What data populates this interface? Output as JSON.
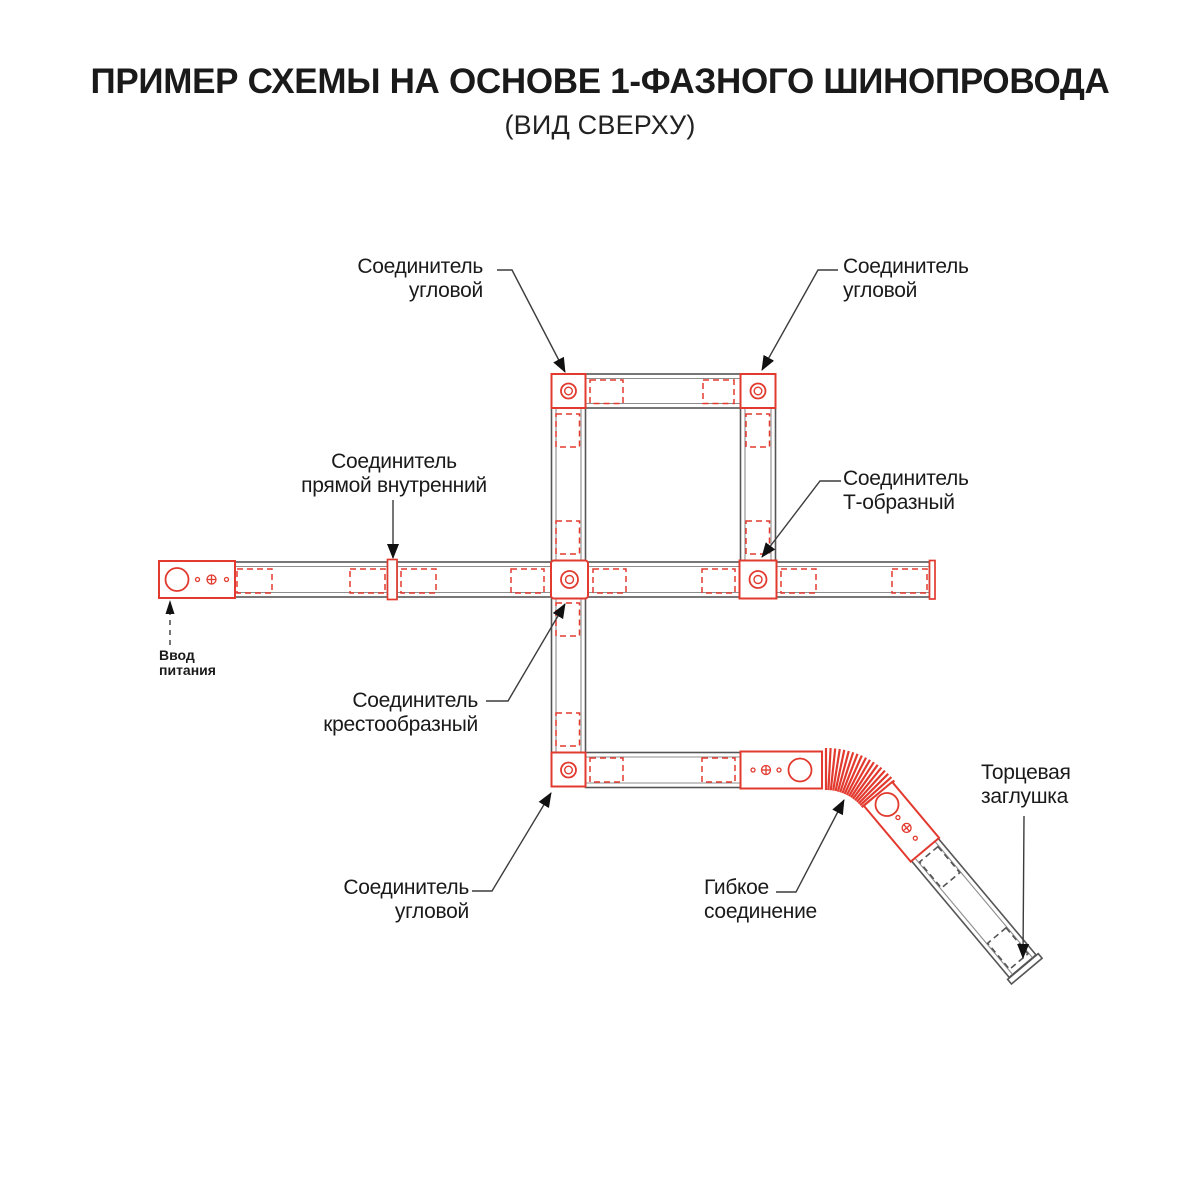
{
  "title": "ПРИМЕР СХЕМЫ НА ОСНОВЕ 1-ФАЗНОГО ШИНОПРОВОДА",
  "subtitle": "(ВИД СВЕРХУ)",
  "labels": {
    "corner_top_left": "Соединитель\nугловой",
    "corner_top_right": "Соединитель\nугловой",
    "straight_internal": "Соединитель\nпрямой внутренний",
    "t_shaped": "Соединитель\nТ-образный",
    "power_input": "Ввод\nпитания",
    "cross_shaped": "Соединитель\nкрестообразный",
    "corner_bottom": "Соединитель\nугловой",
    "flexible": "Гибкое\nсоединение",
    "end_cap": "Торцевая\nзаглушка"
  },
  "colors": {
    "track_red": "#e23a2f",
    "track_gray": "#555555",
    "rail_gray": "#8d8d8d",
    "leader_gray": "#3c3c3c",
    "text_dark": "#1a1a1a",
    "background": "#ffffff"
  }
}
